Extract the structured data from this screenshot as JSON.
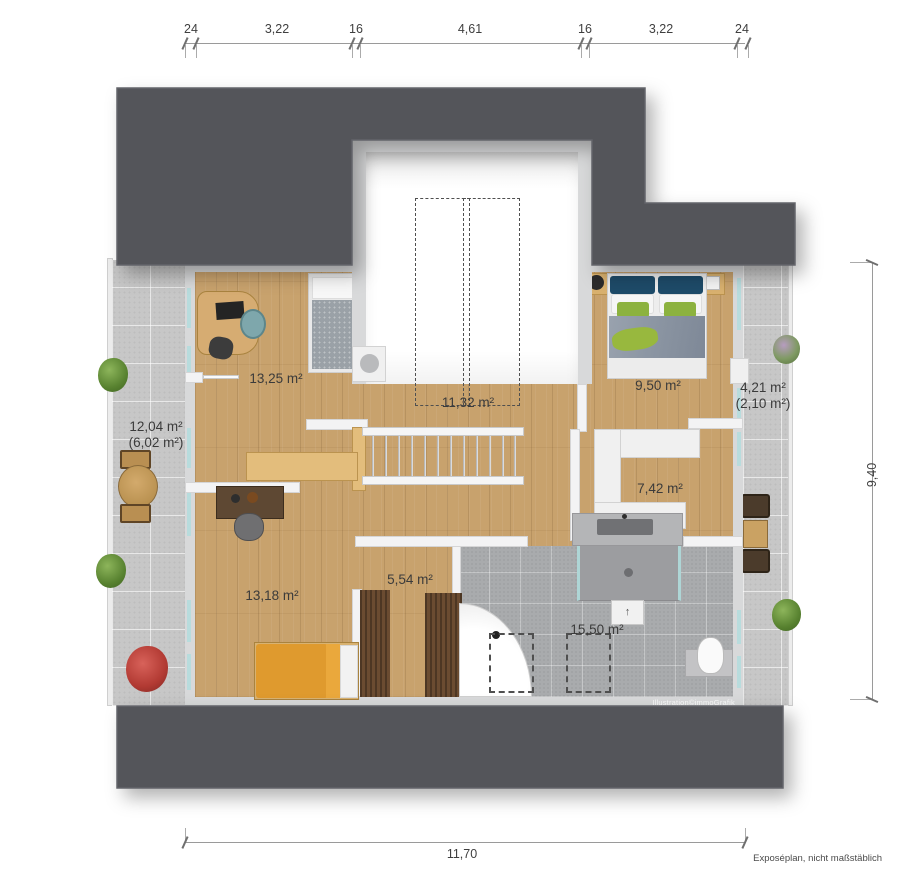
{
  "plan": {
    "footer_note": "Exposéplan, nicht maßstäblich",
    "watermark": "Illustration©immoGrafik"
  },
  "dimensions": {
    "top": [
      "24",
      "3,22",
      "16",
      "4,61",
      "16",
      "3,22",
      "24"
    ],
    "right": "9,40",
    "bottom": "11,70"
  },
  "rooms": {
    "office": {
      "area": "13,25 m²"
    },
    "stairwell_void": {
      "area": "11,32 m²"
    },
    "bedroom_top_right": {
      "area": "9,50 m²"
    },
    "balcony_right": {
      "area": "4,21 m²",
      "area_secondary": "(2,10 m²)"
    },
    "terrace_left": {
      "area": "12,04 m²",
      "area_secondary": "(6,02 m²)"
    },
    "dressing_room": {
      "area": "7,42 m²"
    },
    "bedroom_bottom_left": {
      "area": "13,18 m²"
    },
    "closet": {
      "area": "5,54 m²"
    },
    "bathroom": {
      "area": "15,50 m²"
    }
  },
  "bathroom_entry_arrow": "↑",
  "colors": {
    "roof": "#54555a",
    "outer_wall": "#d8d9da",
    "wood_floor": "#c8a26d",
    "terrace_tile": "#c7c7c7",
    "bath_tile": "#a9abad",
    "window_glass": "#b8dcdd",
    "label_text": "#3b3b3b",
    "bed_navy": "#1e4b69",
    "bed_green": "#8cb23f",
    "bed_orange": "#df9a2e"
  }
}
